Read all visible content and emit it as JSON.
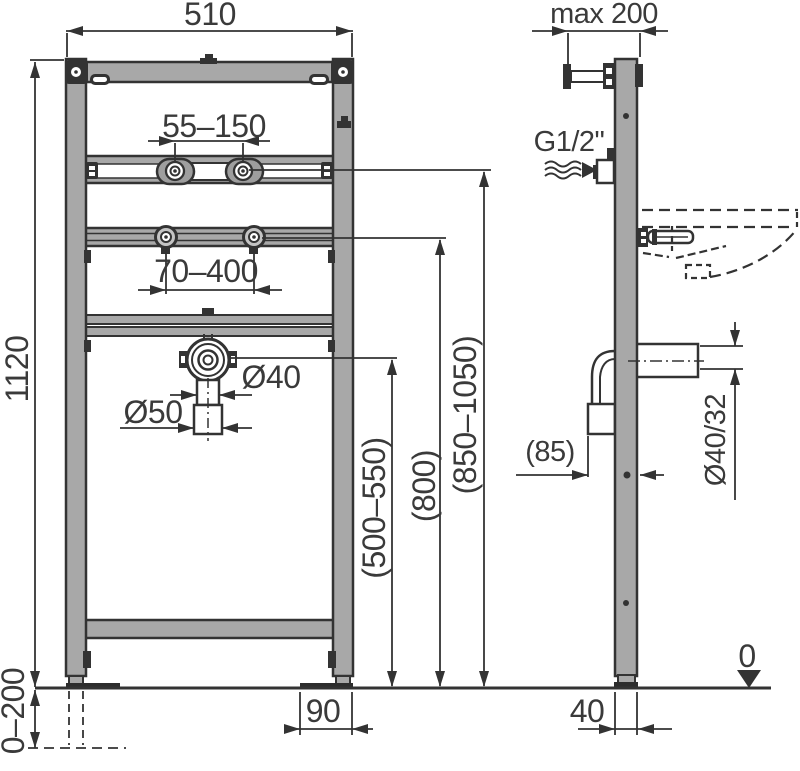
{
  "drawing": {
    "type": "installation frame for washbasin - dimensioned technical drawing",
    "views": {
      "left": "front view",
      "right": "side view"
    },
    "colors": {
      "line": "#333333",
      "metal_fill": "#a8a8a8",
      "dark_fill": "#2d2d2d",
      "text": "#3a3a3a",
      "background": "#ffffff"
    }
  },
  "labels": {
    "width_510": "510",
    "wall_max_200": "max 200",
    "basin_bolts_55_150": "55–150",
    "tap_holes_70_400": "70–400",
    "dia_40": "Ø40",
    "dia_50": "Ø50",
    "height_1120": "1120",
    "drain_height_500_550": "(500–550)",
    "tap_height_800": "(800)",
    "rim_height_850_1050": "(850–1050)",
    "water_conn_g12": "G1/2\"",
    "trap_offset_85": "(85)",
    "outlet_dia_40_32": "Ø40/32",
    "foot_plate_90": "90",
    "profile_depth_40": "40",
    "foot_adjust_0_200": "0–200",
    "floor_level_0": "0"
  }
}
